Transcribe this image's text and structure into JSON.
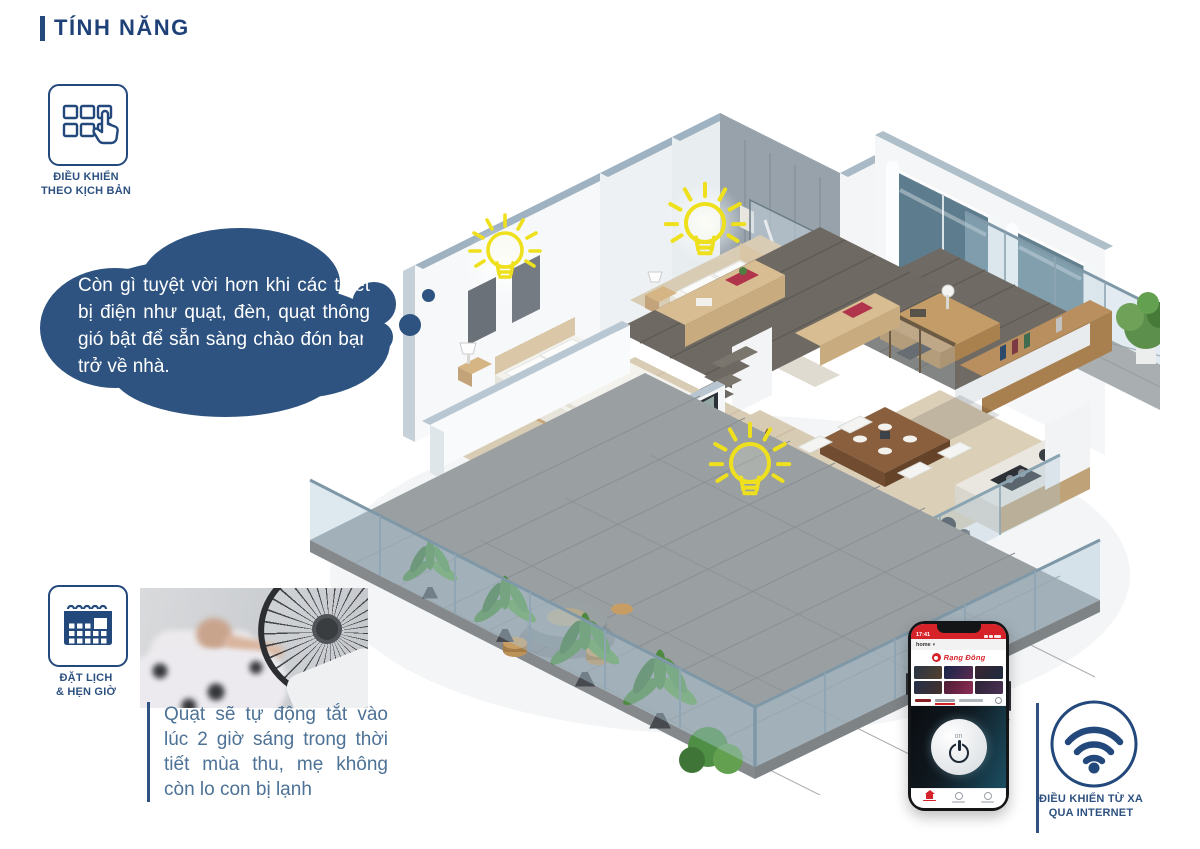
{
  "header": {
    "title": "TÍNH NĂNG"
  },
  "features": {
    "scenario": {
      "icon": "scenario-grid-hand-icon",
      "line1": "ĐIỀU KHIỂN",
      "line2": "THEO KỊCH BẢN"
    },
    "schedule": {
      "icon": "calendar-icon",
      "line1": "ĐẶT LỊCH",
      "line2": "& HẸN GIỜ",
      "caption": "Quạt sẽ tự động tắt vào lúc 2 giờ sáng trong thời tiết mùa thu, mẹ không còn lo con bị lạnh"
    },
    "remote": {
      "icon": "wifi-icon",
      "line1": "ĐIỀU KHIỂN TỪ XA",
      "line2": "QUA INTERNET"
    }
  },
  "thought_bubble": {
    "text": "Còn gì tuyệt vời hơn khi các thiết bị điện như quạt, đèn, quạt thông gió bật để sẵn sàng chào đón bạn trở về nhà.",
    "background": "#2e5380",
    "text_color": "#ffffff"
  },
  "phone": {
    "time": "17:41",
    "home_label": "home",
    "brand": "Rạng Đông",
    "power_label": "on",
    "accent_red": "#d6232a"
  },
  "illustration": {
    "description": "Isometric cutaway 3D smart home with two bedrooms, bathroom, mezzanine study, dining-kitchen, living room and plant-lined terrace",
    "lightbulbs": 3,
    "bulb_color": "#f0e41f"
  },
  "colors": {
    "accent_navy": "#23497c",
    "bubble_blue": "#2e5380",
    "caption_blue": "#4d7296"
  }
}
